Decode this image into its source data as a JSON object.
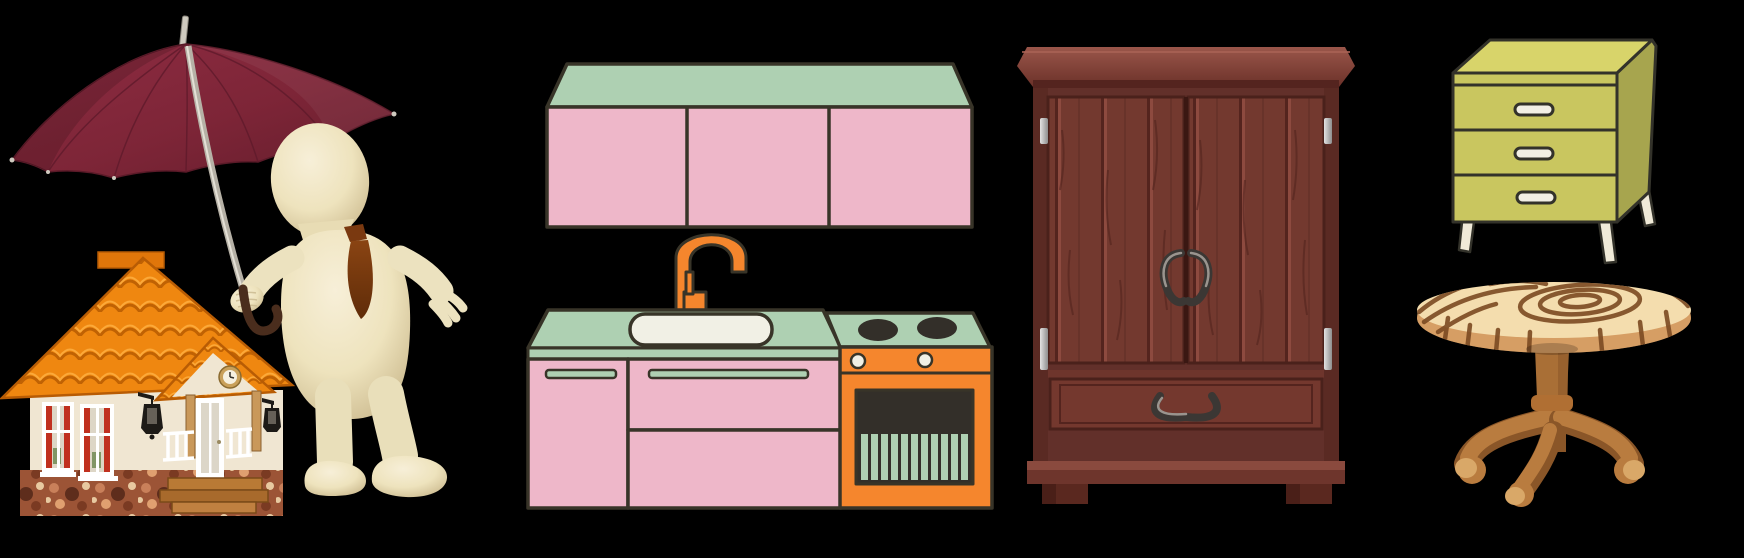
{
  "scene": {
    "background_color": "#000000",
    "items": [
      {
        "id": "insurance-illustration",
        "label": "3D figure with tie holding a maroon umbrella sheltering a small house",
        "type": "3d-render",
        "colors": {
          "umbrella_canopy": "#7d2537",
          "umbrella_canopy_dark": "#5f1c2a",
          "umbrella_pole": "#b6b1a6",
          "umbrella_handle": "#4a2d1d",
          "figure_body": "#efe5c2",
          "figure_shadow": "#c6b488",
          "tie": "#7a3910",
          "house_roof": "#ef8710",
          "house_roof_shadow": "#c06203",
          "house_wall": "#f0e6d2",
          "house_foundation": "#9c5436",
          "window_curtain": "#c0301f",
          "lantern": "#1d1a17",
          "porch_wood": "#b97a35"
        }
      },
      {
        "id": "kitchen-unit",
        "label": "Pink and mint kitchen unit with wall cabinet, sink, faucet and orange stove",
        "type": "flat-illustration",
        "colors": {
          "counter_green": "#aed0b2",
          "cabinet_pink": "#eeb7c9",
          "outline": "#383428",
          "stove_orange": "#f5862d",
          "sink_white": "#f1f0e5",
          "oven_window": "#332f29",
          "faucet_orange": "#f5862d"
        }
      },
      {
        "id": "wardrobe",
        "label": "Dark red-brown wooden wardrobe with two doors and one drawer",
        "type": "flat-illustration",
        "colors": {
          "wood": "#6e352c",
          "wood_light": "#83443a",
          "wood_dark": "#56251f",
          "hinges": "#c9c9c9",
          "handles": "#3b3734"
        }
      },
      {
        "id": "dresser",
        "label": "Yellow-green three-drawer dresser with white pill handles and splayed legs",
        "type": "flat-illustration",
        "colors": {
          "front": "#c9c65f",
          "top": "#d8d46a",
          "side": "#a7a54e",
          "handles": "#f2efe4",
          "outline": "#33322a",
          "legs": "#f0ead8"
        }
      },
      {
        "id": "round-table",
        "label": "Round wooden pedestal table with wood-grain top and curved legs",
        "type": "flat-illustration",
        "colors": {
          "top": "#f4ddae",
          "grain": "#7c4a22",
          "rim": "#e0ac72",
          "base": "#b97c3f",
          "base_dark": "#8a5628",
          "foot_highlight": "#d9a868"
        }
      }
    ]
  }
}
